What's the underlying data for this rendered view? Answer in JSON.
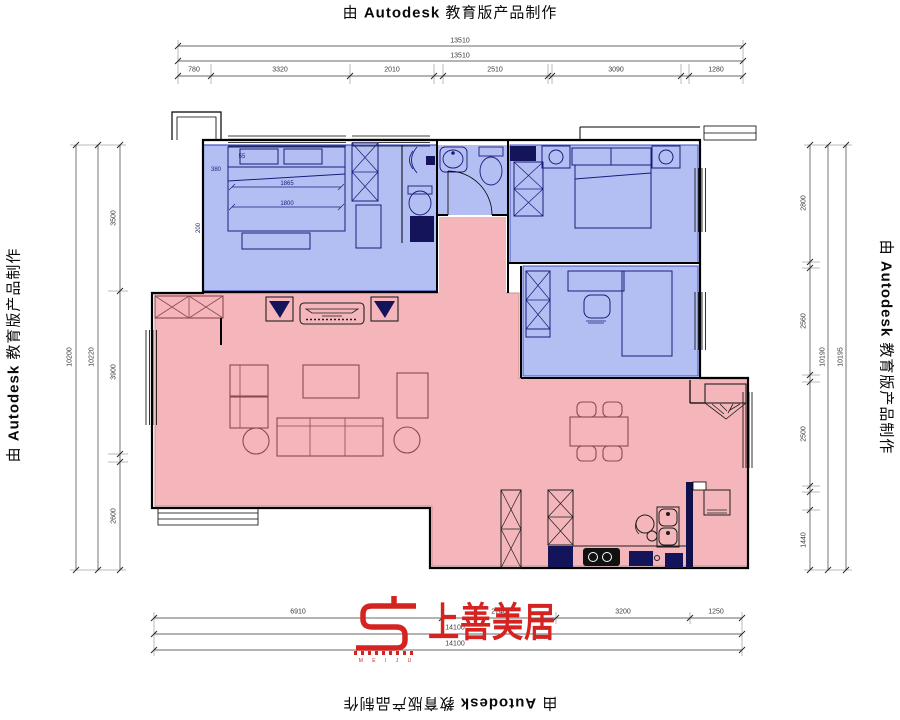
{
  "watermark": {
    "prefix": "由",
    "brand": "Autodesk",
    "suffix": "教育版产品制作"
  },
  "logo": {
    "brand_cn": "上善美居",
    "brand_letters": "M E I J U",
    "color": "#d42321"
  },
  "dims": {
    "top": {
      "total_a": "13510",
      "total_b": "13510",
      "s1": "780",
      "s2": "3320",
      "s3": "2010",
      "s4": "2510",
      "s5": "3090",
      "s6": "1280"
    },
    "left": {
      "chain_a": "10200",
      "chain_b": "10220",
      "s1": "3500",
      "s2": "3900",
      "s3": "2600"
    },
    "right": {
      "s1": "2800",
      "s2": "2560",
      "s3": "2500",
      "s4": "1440",
      "chain_a": "10190",
      "chain_b": "10195"
    },
    "bottom": {
      "s1": "6910",
      "s2": "2740",
      "s3": "3200",
      "s4": "1250",
      "total_a": "14100",
      "total_b": "14100"
    },
    "bed": {
      "w1": "1865",
      "w2": "1800",
      "a": "55",
      "b": "380",
      "c": "200"
    }
  },
  "colors": {
    "room_blue": "#b3bff2",
    "room_blue_border": "#3c50c8",
    "room_pink": "#f5b6bb",
    "room_pink_border": "#cf8d93",
    "furniture_navy": "#14145a",
    "furniture_maroon": "#8d4a50",
    "wall_black": "#000000",
    "dim_gray": "#3a3a3a",
    "logo_red": "#d42321"
  }
}
